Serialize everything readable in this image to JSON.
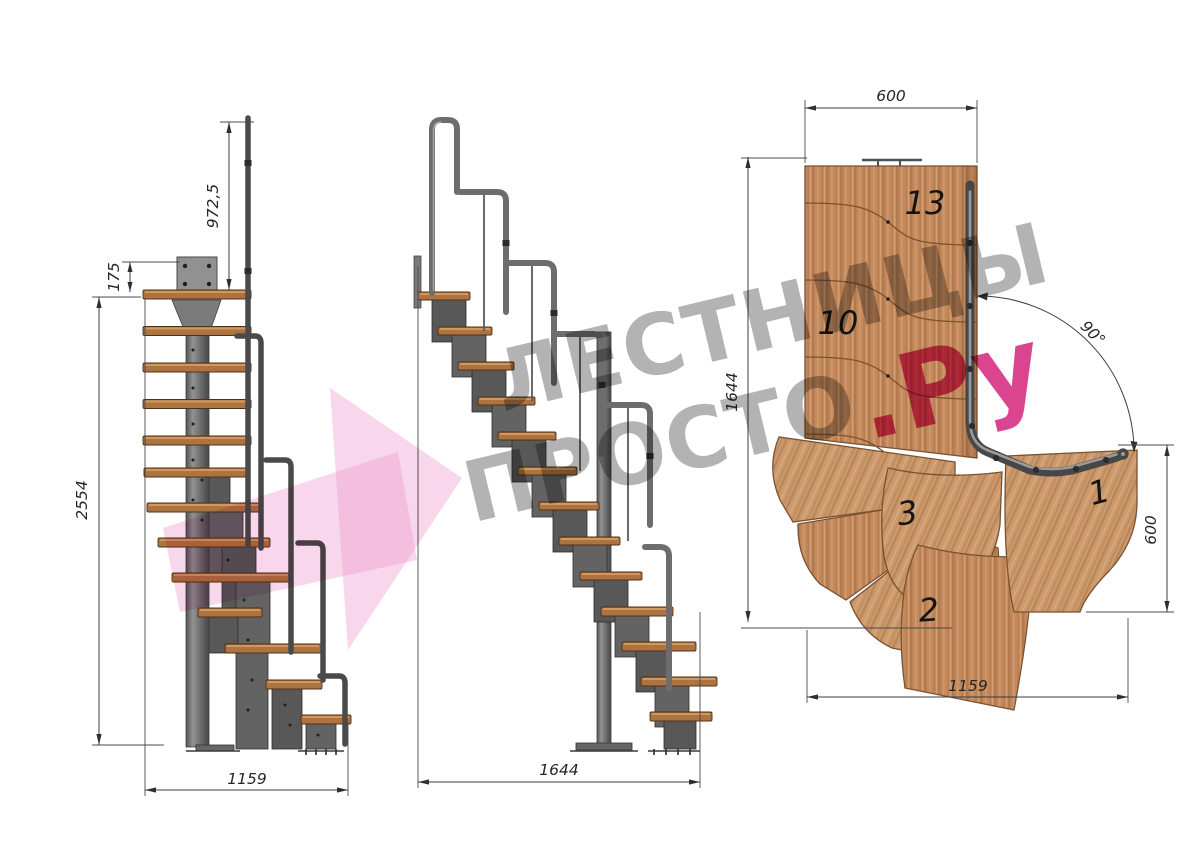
{
  "watermark": {
    "line1": "ЛЕСТНИЦЫ",
    "line2": "ПРОСТО",
    "suffix": ".Ру"
  },
  "views": {
    "side": {
      "handrail_height": "972,5",
      "top_offset": "175",
      "total_height": "2554",
      "depth": "1159"
    },
    "front": {
      "width": "1644"
    },
    "plan": {
      "top_width": "600",
      "left_length": "1644",
      "angle": "90°",
      "right_width": "600",
      "bottom_length": "1159",
      "steps": [
        "13",
        "10",
        "3",
        "1",
        "2"
      ]
    }
  },
  "colors": {
    "wood": "#c4895c",
    "wood_light": "#cc9a6e",
    "tread": "#ad7340",
    "metal": "#6e6e6e",
    "rail": "#4a4a4a",
    "dimension": "#3c3c3c",
    "watermark_gray": "#808080",
    "watermark_pink": "#d21c76",
    "logo_pink": "#ef9ed0"
  }
}
